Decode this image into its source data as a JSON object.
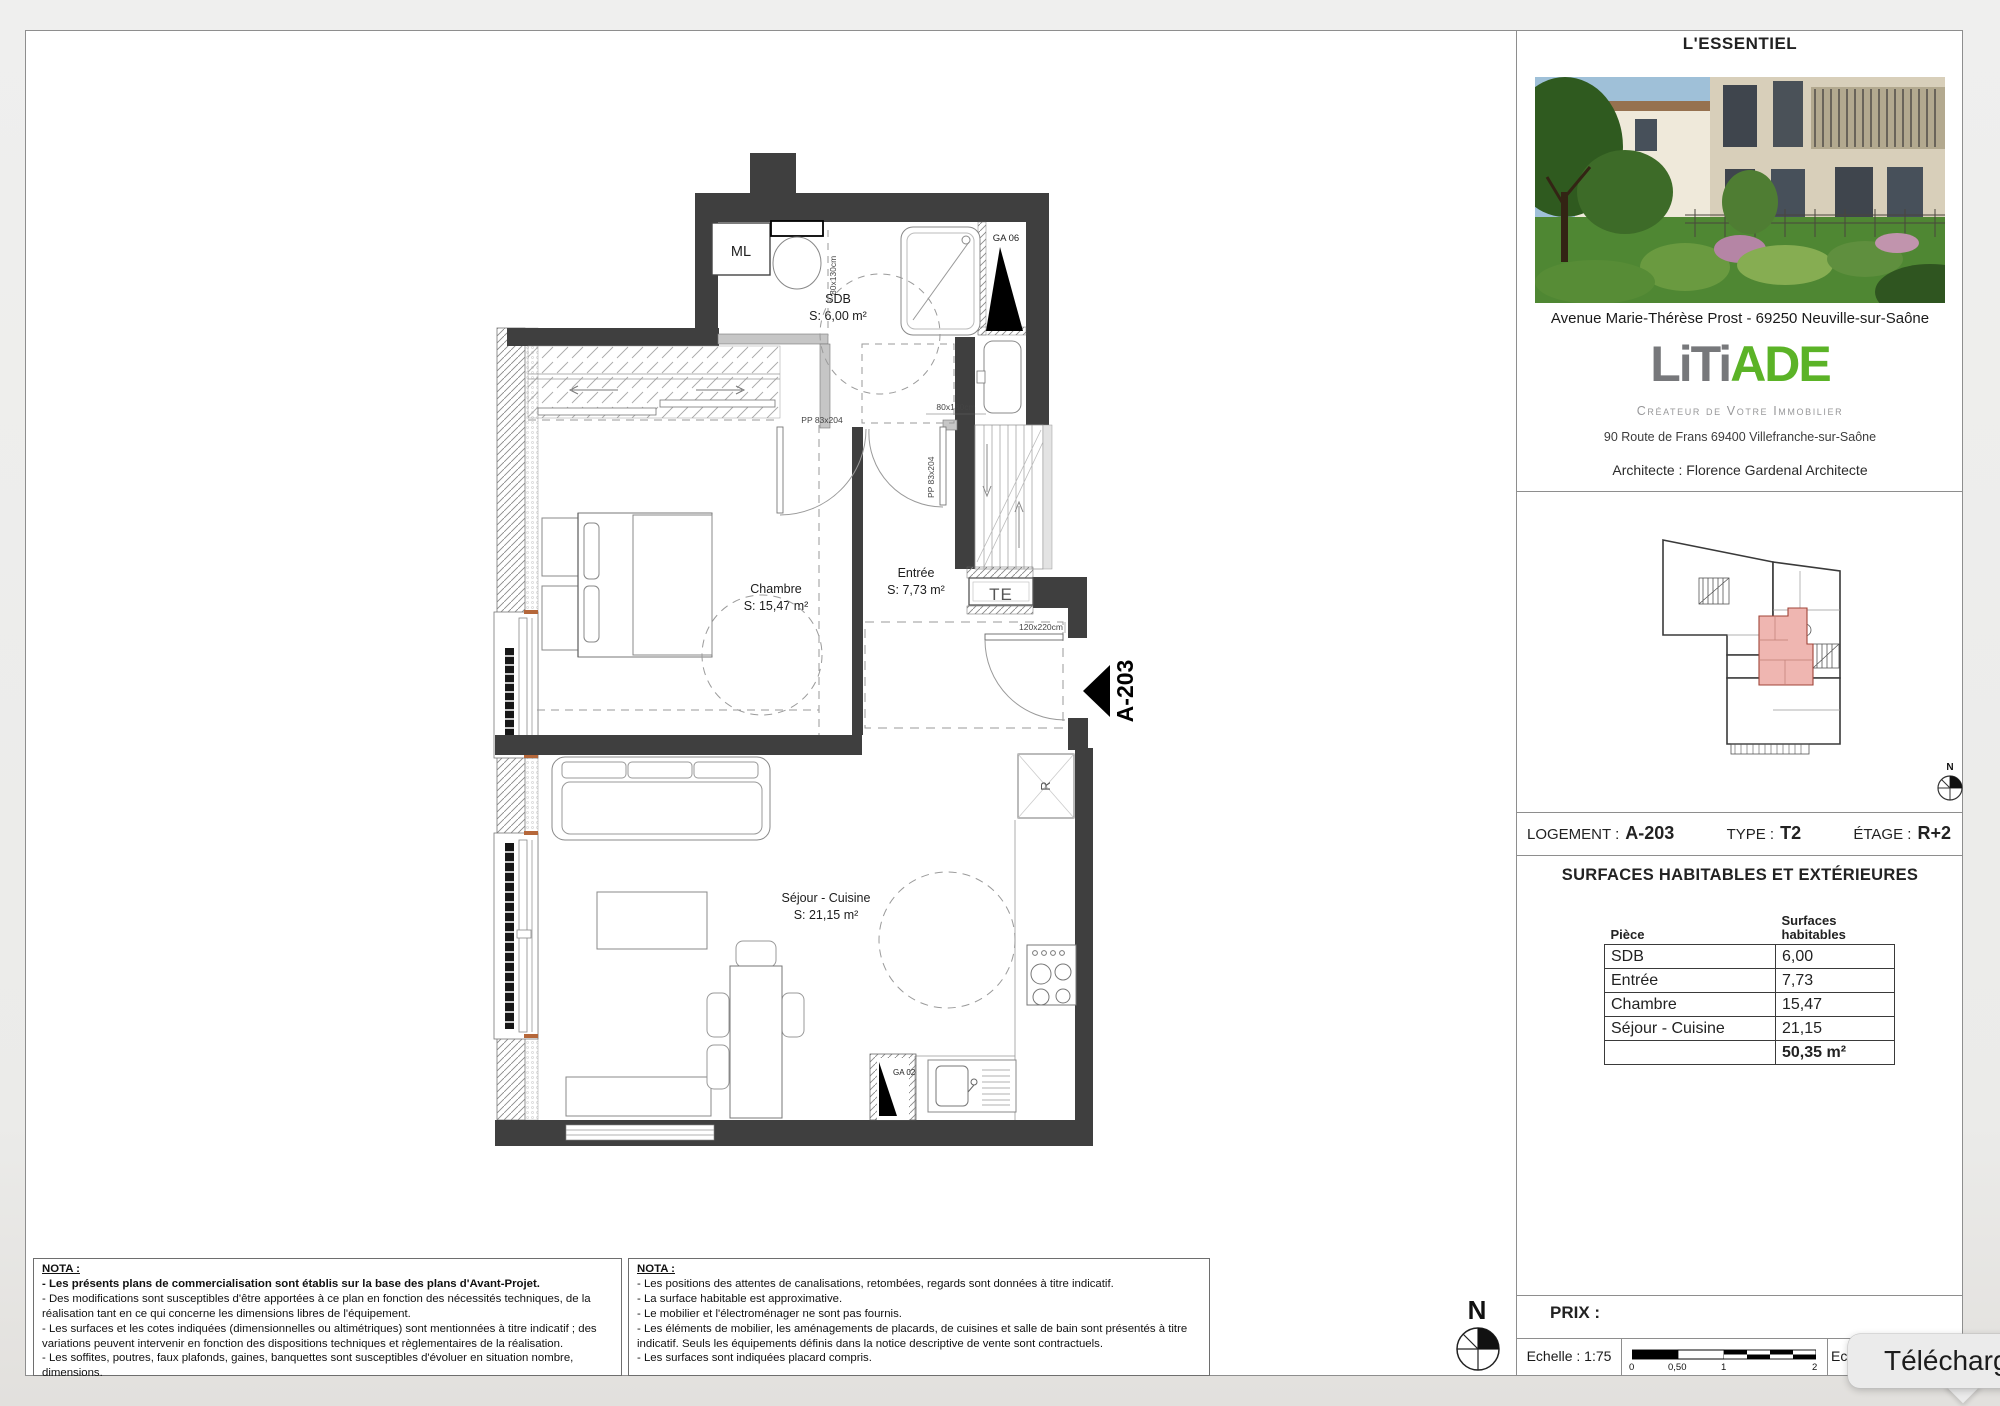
{
  "sidebar": {
    "title": "L'ESSENTIEL",
    "photo_caption": "Avenue Marie-Thérèse Prost - 69250 Neuville-sur-Saône",
    "logo_gray": "LiTi",
    "logo_green": "ADE",
    "logo_tagline": "Créateur de Votre Immobilier",
    "logo_address": "90 Route de Frans 69400 Villefranche-sur-Saône",
    "architect": "Architecte : Florence Gardenal Architecte",
    "logement_label": "LOGEMENT :",
    "logement_value": "A-203",
    "type_label": "TYPE :",
    "type_value": "T2",
    "etage_label": "ÉTAGE :",
    "etage_value": "R+2",
    "surfaces_title": "SURFACES HABITABLES ET EXTÉRIEURES",
    "col_piece": "Pièce",
    "col_surfaces_line1": "Surfaces",
    "col_surfaces_line2": "habitables",
    "rows": [
      {
        "piece": "SDB",
        "value": "6,00"
      },
      {
        "piece": "Entrée",
        "value": "7,73"
      },
      {
        "piece": "Chambre",
        "value": "15,47"
      },
      {
        "piece": "Séjour - Cuisine",
        "value": "21,15"
      }
    ],
    "total": "50,35 m²",
    "prix_label": "PRIX :",
    "echelle": "Echelle : 1:75",
    "echelle_partial": "Ec",
    "ticks": {
      "t0": "0",
      "t1": "0,50",
      "t2": "1",
      "t3": "2"
    },
    "north": "N"
  },
  "plan": {
    "sdb_name": "SDB",
    "sdb_surface": "S: 6,00 m²",
    "chambre_name": "Chambre",
    "chambre_surface": "S: 15,47 m²",
    "entree_name": "Entrée",
    "entree_surface": "S: 7,73 m²",
    "sejour_name": "Séjour - Cuisine",
    "sejour_surface": "S: 21,15 m²",
    "ml": "ML",
    "te": "TE",
    "r": "R",
    "ga06": "GA 06",
    "ga02": "GA 02",
    "dim_wc": "80x130cm",
    "dim_bath": "80x130cm",
    "door_chambre": "PP 83x204",
    "door_sdb": "PP 83x204",
    "door_entree": "120x220cm",
    "unit_marker": "A-203",
    "north": "N"
  },
  "notes_left": {
    "title": "NOTA :",
    "line1": "- Les présents plans de commercialisation sont établis sur la base des plans d'Avant-Projet.",
    "line2": "- Des modifications sont susceptibles d'être apportées à ce plan en fonction des nécessités techniques, de la réalisation tant en ce qui concerne les dimensions libres de l'équipement.",
    "line3": "- Les surfaces et les cotes indiquées (dimensionnelles ou altimétriques) sont mentionnées à titre indicatif ; des variations peuvent intervenir en fonction des dispositions techniques et règlementaires de la réalisation.",
    "line4": "- Les soffites, poutres, faux plafonds, gaines, banquettes sont susceptibles d'évoluer en situation nombre, dimensions."
  },
  "notes_right": {
    "title": "NOTA :",
    "line1": "- Les positions des attentes de canalisations, retombées, regards sont données à titre indicatif.",
    "line2": "- La surface habitable est approximative.",
    "line3": "- Le mobilier et l'électroménager ne sont pas fournis.",
    "line4": "- Les éléments de mobilier, les aménagements de placards, de cuisines et salle de bain sont présentés à titre indicatif. Seuls les équipements définis dans la notice descriptive de vente sont contractuels.",
    "line5": "- Les surfaces sont indiquées placard compris."
  },
  "tooltip": {
    "text": "Téléchargem"
  },
  "colors": {
    "logo_gray": "#77787b",
    "logo_green": "#5bb327",
    "wall": "#3f3f3f",
    "unit_highlight": "#efb6b1"
  }
}
